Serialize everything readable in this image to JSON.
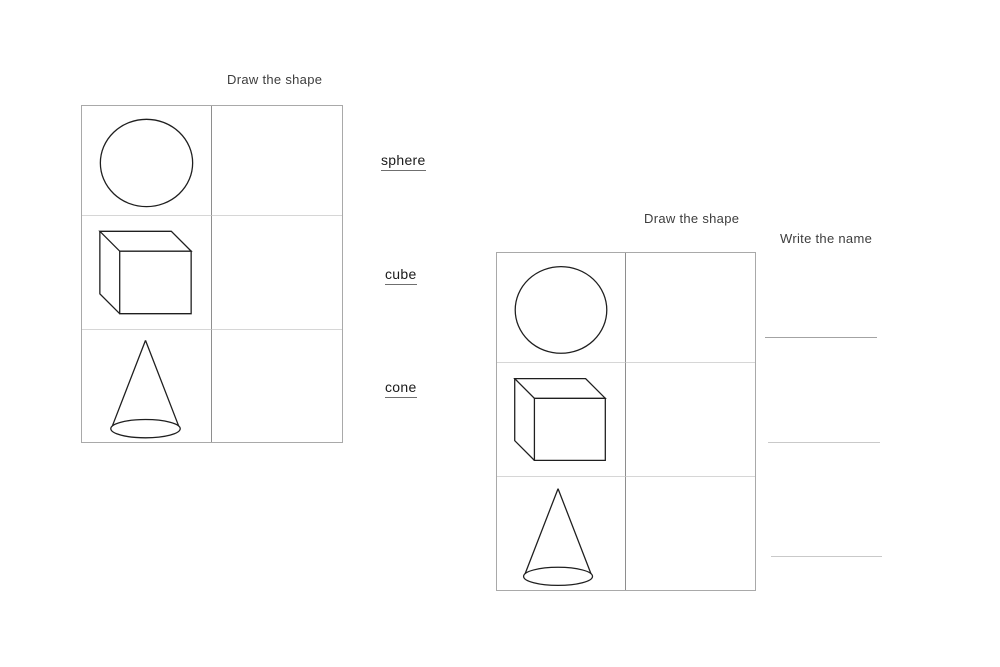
{
  "left_worksheet": {
    "title": "Draw the shape",
    "shapes": [
      "sphere",
      "cube",
      "cone"
    ],
    "labels": [
      "sphere",
      "cube",
      "cone"
    ]
  },
  "right_worksheet": {
    "title": "Draw the shape",
    "name_heading": "Write the name",
    "shapes": [
      "sphere",
      "cube",
      "cone"
    ],
    "answer_line_count": 3
  },
  "colors": {
    "ink": "#1f1f1f",
    "table_border": "#a9a9a9",
    "column_divider": "#8e8e8e",
    "row_divider": "#d6d6d6",
    "answer_line": "#c9c9c9",
    "heading_text": "#3d3d3d"
  }
}
